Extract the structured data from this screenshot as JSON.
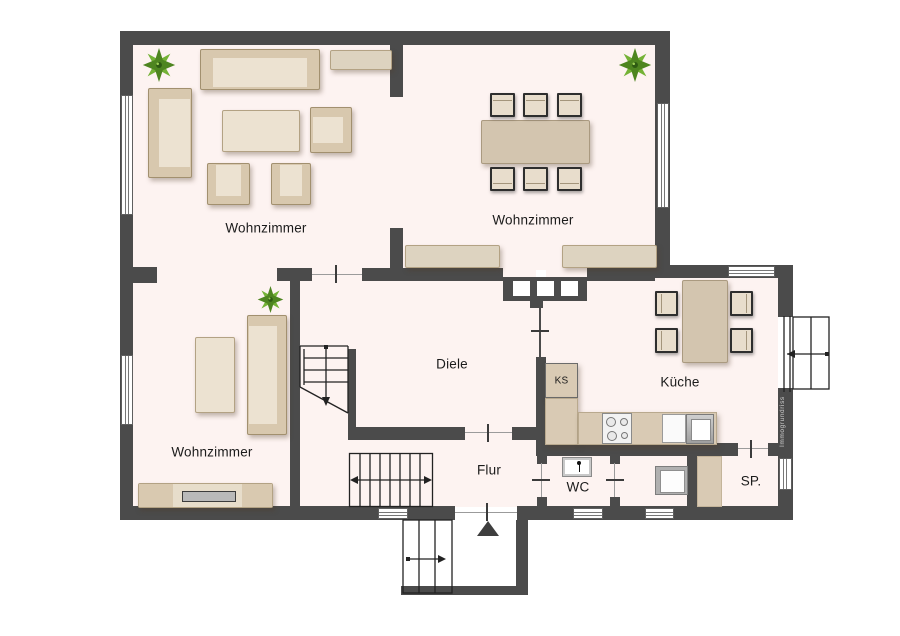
{
  "floorplan": {
    "rooms": {
      "living1": {
        "label": "Wohnzimmer"
      },
      "living2": {
        "label": "Wohnzimmer"
      },
      "living3": {
        "label": "Wohnzimmer"
      },
      "diele": {
        "label": "Diele"
      },
      "kueche": {
        "label": "Küche"
      },
      "flur": {
        "label": "Flur"
      },
      "wc": {
        "label": "WC"
      },
      "sp": {
        "label": "SP."
      },
      "ks": {
        "label": "KS"
      }
    },
    "watermark": "Immogrundriss",
    "colors": {
      "wall": "#4b4b4b",
      "floor": "#fdf3f1",
      "furn-frame": "#d8c8ae",
      "furn-light": "#ece2d1",
      "table": "#d3c5af",
      "plant-green": "#6fae33"
    }
  }
}
